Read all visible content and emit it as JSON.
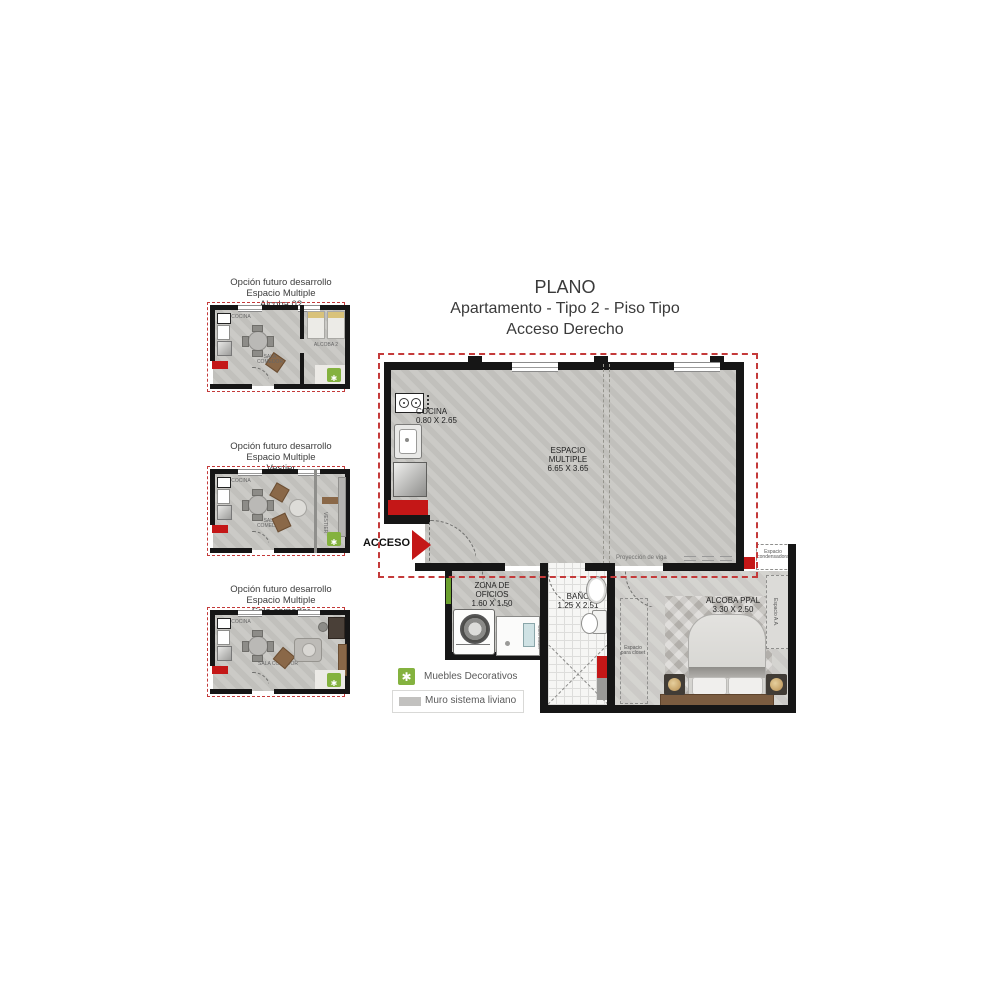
{
  "title": {
    "line1": "PLANO",
    "line2": "Apartamento - Tipo 2 - Piso Tipo",
    "line3": "Acceso Derecho"
  },
  "options": [
    {
      "l1": "Opción futuro desarrollo",
      "l2": "Espacio Multiple",
      "l3": "Alcoba 02",
      "room_label": "ALCOBA 2"
    },
    {
      "l1": "Opción futuro desarrollo",
      "l2": "Espacio Multiple",
      "l3": "Vestier",
      "room_label": "VESTIER"
    },
    {
      "l1": "Opción futuro desarrollo",
      "l2": "Espacio Multiple",
      "l3": "Sala comedor",
      "room_label": "SALA COMEDOR"
    }
  ],
  "mini_common": {
    "cocina": "COCINA",
    "sala": "SALA COMEDOR"
  },
  "plan": {
    "acceso": "ACCESO",
    "cocina_name": "COCINA",
    "cocina_dims": "0.80 X 2.65",
    "espacio_l1": "ESPACIO",
    "espacio_l2": "MULTIPLE",
    "espacio_dims": "6.65 X 3.65",
    "zona_l1": "ZONA DE",
    "zona_l2": "OFICIOS",
    "zona_dims": "1.60 X 1.50",
    "bano_name": "BAÑO",
    "bano_dims": "1.25 X 2.51",
    "alcoba_name": "ALCOBA PPAL",
    "alcoba_dims": "3.30 X 2.50",
    "proyeccion": "Proyección de viga",
    "condensadora_l1": "Espacio",
    "condensadora_l2": "condensadora",
    "espacio_aa": "Espacio A.A.",
    "closet_l1": "Espacio",
    "closet_l2": "para closet",
    "calentador": "Calentador"
  },
  "legend": {
    "item1": "Muebles Decorativos",
    "item2": "Muro sistema liviano",
    "asterisk_glyph": "✱"
  },
  "colors": {
    "boundary_red": "#c43a3a",
    "accent_red": "#c41717",
    "accent_green": "#84b23f",
    "wall_black": "#161616",
    "floor_gray": "#c8c7c3"
  }
}
